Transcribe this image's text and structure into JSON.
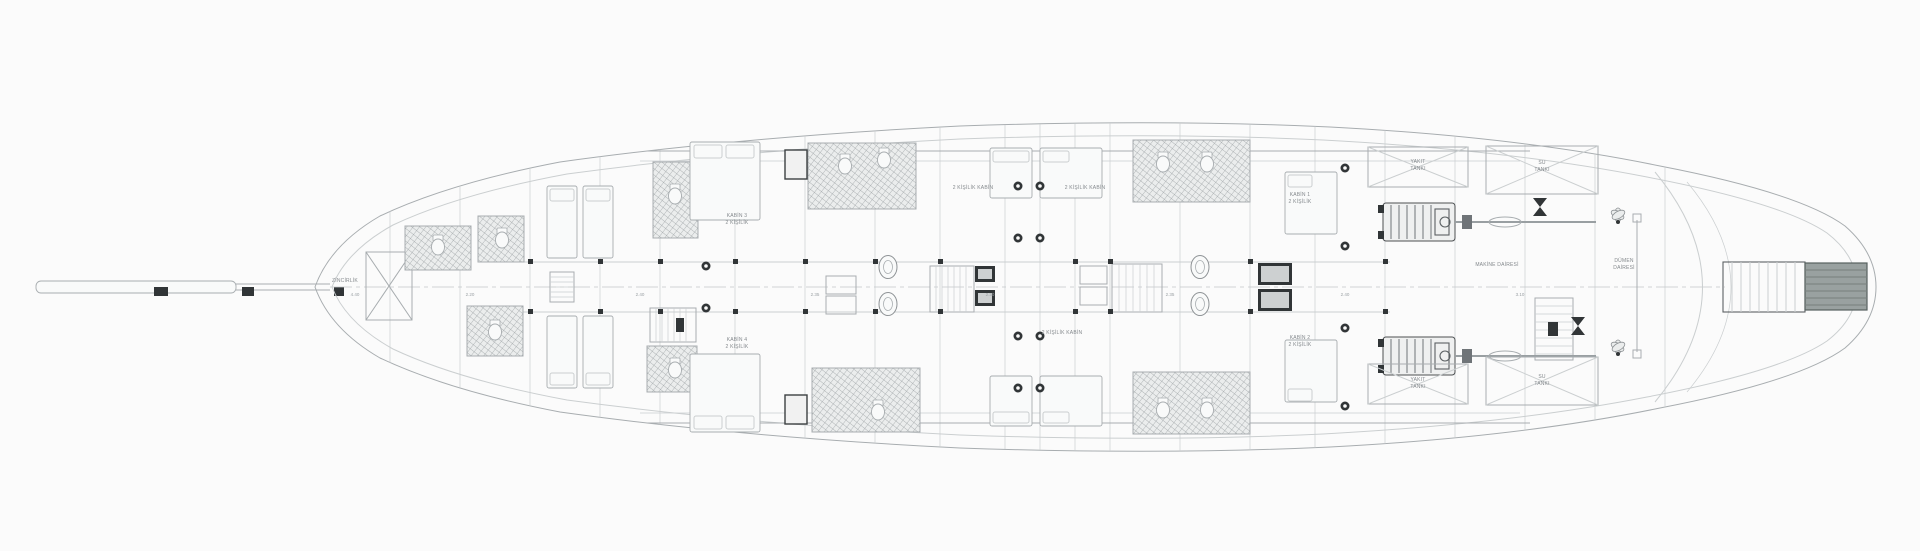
{
  "colors": {
    "paper": "#ffffff",
    "line_light": "#cdd1d3",
    "line_mid": "#a9aeb1",
    "line_dark": "#5a5f62",
    "ink": "#2f3335",
    "label": "#84898d",
    "tile": "#9ba1a4",
    "platform_fill": "#9aa2a1",
    "platform_stripe": "#767f7d"
  },
  "labels": {
    "forepeak": "ZİNCİRLİK",
    "cabin_mid_upper": {
      "line1": "KABİN 3",
      "line2": "2 KİŞİLİK"
    },
    "cabin_mid_lower": {
      "line1": "KABİN 4",
      "line2": "2 KİŞİLİK"
    },
    "cabin_aft_upper": {
      "line1": "KABİN 1",
      "line2": "2 KİŞİLİK"
    },
    "cabin_aft_lower": {
      "line1": "KABİN 2",
      "line2": "2 KİŞİLİK"
    },
    "cabin_note_upper_1": "2 KİŞİLİK KABİN",
    "cabin_note_upper_2": "2 KİŞİLİK KABİN",
    "cabin_note_lower_1": "2 KİŞİLİK KABİN",
    "tank_fuel": {
      "line1": "YAKIT",
      "line2": "TANKI"
    },
    "tank_water": {
      "line1": "SU",
      "line2": "TANKI"
    },
    "tank_fuel_lower": {
      "line1": "YAKIT",
      "line2": "TANKI"
    },
    "tank_water_lower": {
      "line1": "SU",
      "line2": "TANKI"
    },
    "engine_room": "MAKİNE DAİRESİ",
    "steering": {
      "line1": "DÜMEN",
      "line2": "DAİRESİ"
    }
  },
  "dimensions": [
    "4.40",
    "2.20",
    "2.40",
    "2.35",
    "2.30",
    "2.35",
    "2.40",
    "3.10"
  ]
}
